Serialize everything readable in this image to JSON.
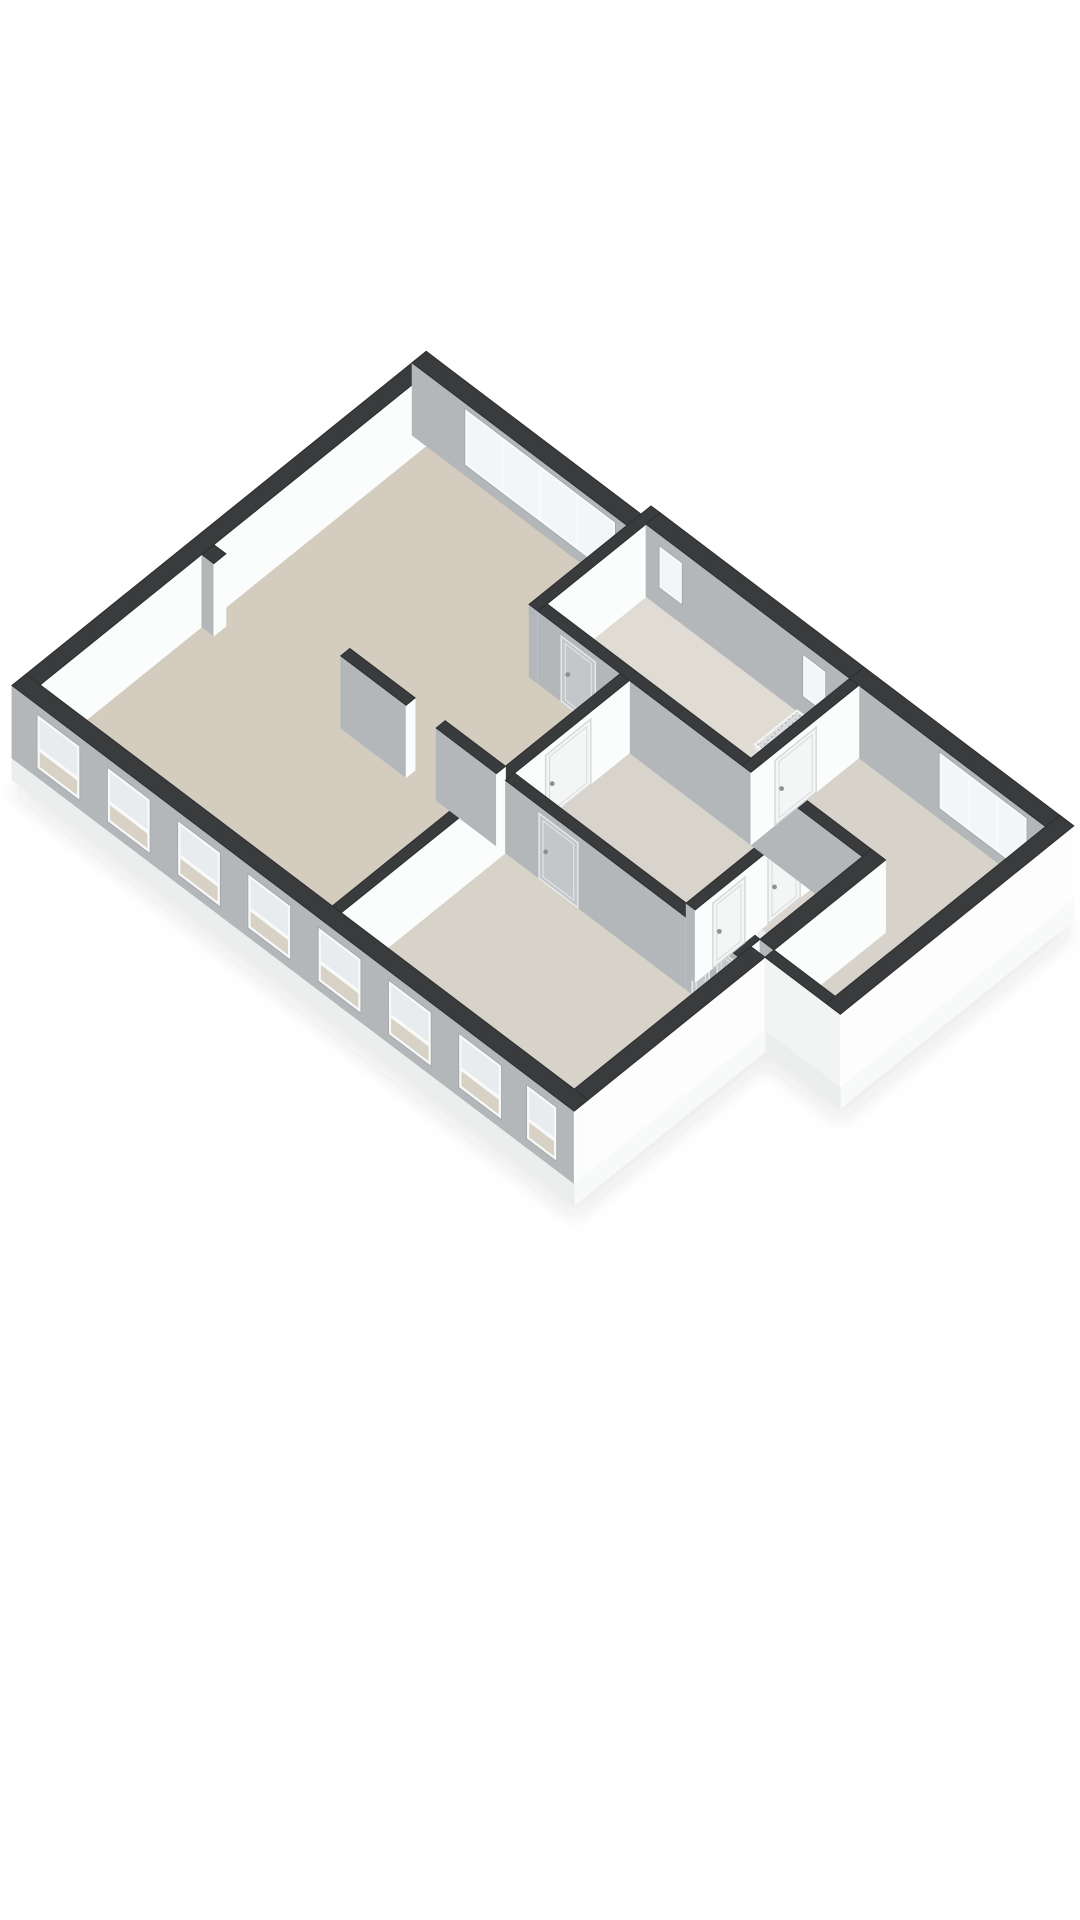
{
  "meta": {
    "title": "3D isometric floor plan rendering",
    "background": "#ffffff"
  },
  "scene": {
    "projection": {
      "ox": 12,
      "oy": 758,
      "ux": 50.2,
      "ax": 38,
      "ay": 40.5,
      "vz": 63
    },
    "wallHeight": 1.15,
    "colors": {
      "top": "#3a3b3d",
      "topStroke": "#2c2e30",
      "sGray": "#b3b7ba",
      "eWhite": "#fbfcfc",
      "extWhiteS": "#f2f3f3",
      "extWhiteE": "#fdfdfd",
      "slabS": "#eceded",
      "slabE": "#f8f9f9",
      "frame": "#f8f9f9",
      "frameStroke": "#9fa4a7",
      "glassBright": "#f3f6f8",
      "glassUpper": "#e8ecee",
      "glassLower": "#d8d1c5",
      "floorLiving": "#d4ccbe",
      "floorHall": "#d8d4cb",
      "floorBath": "#e0dcd4",
      "floorBed": "#d8d3c9",
      "floorWing": "#d7d3ca",
      "floorCell": "#dad6cd",
      "leafGray": "#c3c7c9",
      "leafGrayStroke": "#e8eaeb",
      "leafWhite": "#f4f5f5",
      "leafWhiteStroke": "#d5d8d9",
      "handle": "#8d9092",
      "sinkTop": "#fcfdfd",
      "sinkS": "#eef0f1",
      "sinkE": "#f6f7f8",
      "basin": "#e7eaeb",
      "speckBg": "#dadcdd",
      "speck": "#b2b5b7",
      "red": "#a83732",
      "redTop": "#923028",
      "shadow": "rgba(40,42,44,0.10)"
    },
    "footprint": [
      [
        0,
        0
      ],
      [
        0,
        8.25
      ],
      [
        4.3,
        8.25
      ],
      [
        4.3,
        8.45
      ],
      [
        12.7,
        8.45
      ],
      [
        12.7,
        3.8
      ],
      [
        11.2,
        3.8
      ],
      [
        11.2,
        0
      ]
    ],
    "slab": {
      "z0": -0.35,
      "edges": [
        {
          "kind": "E",
          "x": 12.7,
          "y0": 3.8,
          "y1": 8.45
        },
        {
          "kind": "S",
          "y": 3.8,
          "x0": 11.2,
          "x1": 12.7
        },
        {
          "kind": "E",
          "x": 11.2,
          "y0": 0,
          "y1": 3.8
        },
        {
          "kind": "S",
          "y": 0,
          "x0": 0,
          "x1": 11.2
        }
      ]
    },
    "elements": [
      {
        "t": "floor",
        "name": "floor-living-room",
        "color": "floorLiving",
        "pts": [
          [
            0.28,
            0.28
          ],
          [
            0.28,
            7.97
          ],
          [
            4.28,
            7.97
          ],
          [
            4.28,
            6.02
          ],
          [
            6.1,
            6.02
          ],
          [
            6.1,
            0.28
          ]
        ]
      },
      {
        "t": "floor",
        "name": "floor-bathroom",
        "color": "floorBath",
        "pts": [
          [
            4.46,
            6.2
          ],
          [
            4.46,
            8.17
          ],
          [
            8.52,
            8.17
          ],
          [
            8.52,
            6.2
          ]
        ]
      },
      {
        "t": "floor",
        "name": "floor-hallway",
        "color": "floorHall",
        "pts": [
          [
            6.28,
            3.73
          ],
          [
            6.28,
            6.02
          ],
          [
            9.7,
            6.02
          ],
          [
            9.7,
            3.73
          ]
        ]
      },
      {
        "t": "floor",
        "name": "floor-closet-a",
        "color": "floorCell",
        "pts": [
          [
            9.88,
            3.98
          ],
          [
            9.88,
            4.9
          ],
          [
            10.92,
            4.9
          ],
          [
            10.92,
            3.98
          ]
        ]
      },
      {
        "t": "floor",
        "name": "floor-closet-b",
        "color": "floorCell",
        "pts": [
          [
            9.88,
            5.05
          ],
          [
            9.88,
            6.02
          ],
          [
            10.92,
            6.02
          ],
          [
            10.92,
            5.05
          ]
        ]
      },
      {
        "t": "floor",
        "name": "floor-bedroom-right",
        "color": "floorWing",
        "pts": [
          [
            8.7,
            6.2
          ],
          [
            8.7,
            8.17
          ],
          [
            12.42,
            8.17
          ],
          [
            12.42,
            3.98
          ],
          [
            11.2,
            3.98
          ],
          [
            11.2,
            6.2
          ]
        ]
      },
      {
        "t": "floor",
        "name": "floor-bedroom-bottom",
        "color": "floorBed",
        "pts": [
          [
            6.28,
            0.28
          ],
          [
            6.28,
            3.55
          ],
          [
            10.92,
            3.55
          ],
          [
            10.92,
            0.28
          ]
        ]
      },
      {
        "t": "wall",
        "name": "wall-west-exterior",
        "x0": 0,
        "y0": 0,
        "x1": 0.28,
        "y1": 8.25
      },
      {
        "t": "wall",
        "name": "wall-west-duct-pillar",
        "x0": 0.28,
        "y0": 3.5,
        "x1": 0.52,
        "y1": 3.74
      },
      {
        "t": "wall",
        "name": "wall-north-living",
        "x0": 0,
        "y0": 7.97,
        "x1": 4.28,
        "y1": 8.25,
        "band": {
          "a0": 1.05,
          "a1": 4.05,
          "panes": 4,
          "z0": 0.16,
          "z1": 1.06
        }
      },
      {
        "t": "wall",
        "name": "wall-bathroom-west",
        "x0": 4.28,
        "y0": 6.02,
        "x1": 4.46,
        "y1": 8.45
      },
      {
        "t": "wall",
        "name": "wall-north-bathroom",
        "x0": 4.46,
        "y0": 8.17,
        "x1": 8.52,
        "y1": 8.45,
        "smallWins": [
          [
            4.72,
            5.18
          ],
          [
            7.58,
            8.04
          ]
        ],
        "winZ": [
          0.3,
          0.97
        ]
      },
      {
        "t": "sink",
        "name": "bathroom-sink",
        "x0": 5.0,
        "y0": 6.26,
        "x1": 6.32,
        "y1": 6.72,
        "h": 0.48
      },
      {
        "t": "shower",
        "name": "bathroom-shower-tray",
        "x0": 7.52,
        "y0": 7.28,
        "x1": 8.42,
        "y1": 8.12,
        "h": 0.07
      },
      {
        "t": "wall",
        "name": "wall-north-bedroom-right",
        "x0": 8.52,
        "y0": 8.17,
        "x1": 12.7,
        "y1": 8.45,
        "band": {
          "a0": 10.3,
          "a1": 12.05,
          "panes": 3,
          "z0": 0.16,
          "z1": 1.06
        }
      },
      {
        "t": "wall",
        "name": "wall-bathroom-south",
        "x0": 4.46,
        "y0": 6.02,
        "x1": 8.52,
        "y1": 6.2,
        "leavesS": [
          {
            "a0": 4.92,
            "a1": 5.6
          }
        ]
      },
      {
        "t": "wall",
        "name": "wall-living-east",
        "x0": 6.1,
        "y0": 0.28,
        "x1": 6.28,
        "y1": 6.02,
        "leavesE": [
          {
            "a0": 4.35,
            "a1": 5.25
          }
        ]
      },
      {
        "t": "wall",
        "name": "wall-living-divider-a",
        "x0": 3.0,
        "y0": 3.55,
        "x1": 4.3,
        "y1": 3.73
      },
      {
        "t": "wall",
        "name": "wall-living-divider-b",
        "x0": 4.9,
        "y0": 3.55,
        "x1": 6.1,
        "y1": 3.73
      },
      {
        "t": "wall",
        "name": "wall-hall-south",
        "x0": 6.28,
        "y0": 3.55,
        "x1": 9.88,
        "y1": 3.73,
        "leavesS": [
          {
            "a0": 6.95,
            "a1": 7.72
          }
        ]
      },
      {
        "t": "wall",
        "name": "wall-closets-south",
        "x0": 9.88,
        "y0": 3.55,
        "x1": 10.92,
        "y1": 3.98,
        "leavesS": [
          {
            "a0": 10.0,
            "a1": 10.34
          },
          {
            "a0": 10.5,
            "a1": 10.84
          }
        ]
      },
      {
        "t": "box",
        "name": "toilet-red-marker",
        "x0": 10.42,
        "y0": 4.02,
        "x1": 10.56,
        "y1": 4.14,
        "h": 0.26,
        "side": "red",
        "topc": "redTop"
      },
      {
        "t": "wall",
        "name": "wall-closets-west",
        "x0": 9.7,
        "y0": 3.73,
        "x1": 9.88,
        "y1": 6.02,
        "leavesE": [
          {
            "a0": 4.08,
            "a1": 4.72
          },
          {
            "a0": 5.18,
            "a1": 5.82
          }
        ]
      },
      {
        "t": "wall",
        "name": "wall-bedroom-right-south",
        "x0": 8.7,
        "y0": 6.02,
        "x1": 11.2,
        "y1": 6.2
      },
      {
        "t": "wall",
        "name": "wall-bathroom-east",
        "x0": 8.52,
        "y0": 6.02,
        "x1": 8.7,
        "y1": 8.17,
        "leavesE": [
          {
            "a0": 6.5,
            "a1": 7.32
          }
        ]
      },
      {
        "t": "wall",
        "name": "wall-closets-east",
        "x0": 10.92,
        "y0": 3.98,
        "x1": 11.2,
        "y1": 6.2
      },
      {
        "t": "wall",
        "name": "wall-main-east-exterior",
        "x0": 10.92,
        "y0": 0,
        "x1": 11.2,
        "y1": 3.8,
        "ext": true
      },
      {
        "t": "wall",
        "name": "wall-wing-south-exterior",
        "x0": 11.2,
        "y0": 3.8,
        "x1": 12.7,
        "y1": 3.98,
        "ext": true
      },
      {
        "t": "wall",
        "name": "wall-wing-east-exterior",
        "x0": 12.42,
        "y0": 3.8,
        "x1": 12.7,
        "y1": 8.45,
        "ext": true
      },
      {
        "t": "wall",
        "name": "wall-facade-south",
        "x0": 0,
        "y0": 0,
        "x1": 11.2,
        "y1": 0.28,
        "facadeWins": [
          [
            0.5,
            1.35
          ],
          [
            1.9,
            2.75
          ],
          [
            3.3,
            4.15
          ],
          [
            4.7,
            5.55
          ],
          [
            6.1,
            6.95
          ],
          [
            7.5,
            8.35
          ],
          [
            8.9,
            9.75
          ],
          [
            10.25,
            10.85
          ]
        ],
        "winZ": [
          0.14,
          1.0
        ]
      }
    ]
  }
}
